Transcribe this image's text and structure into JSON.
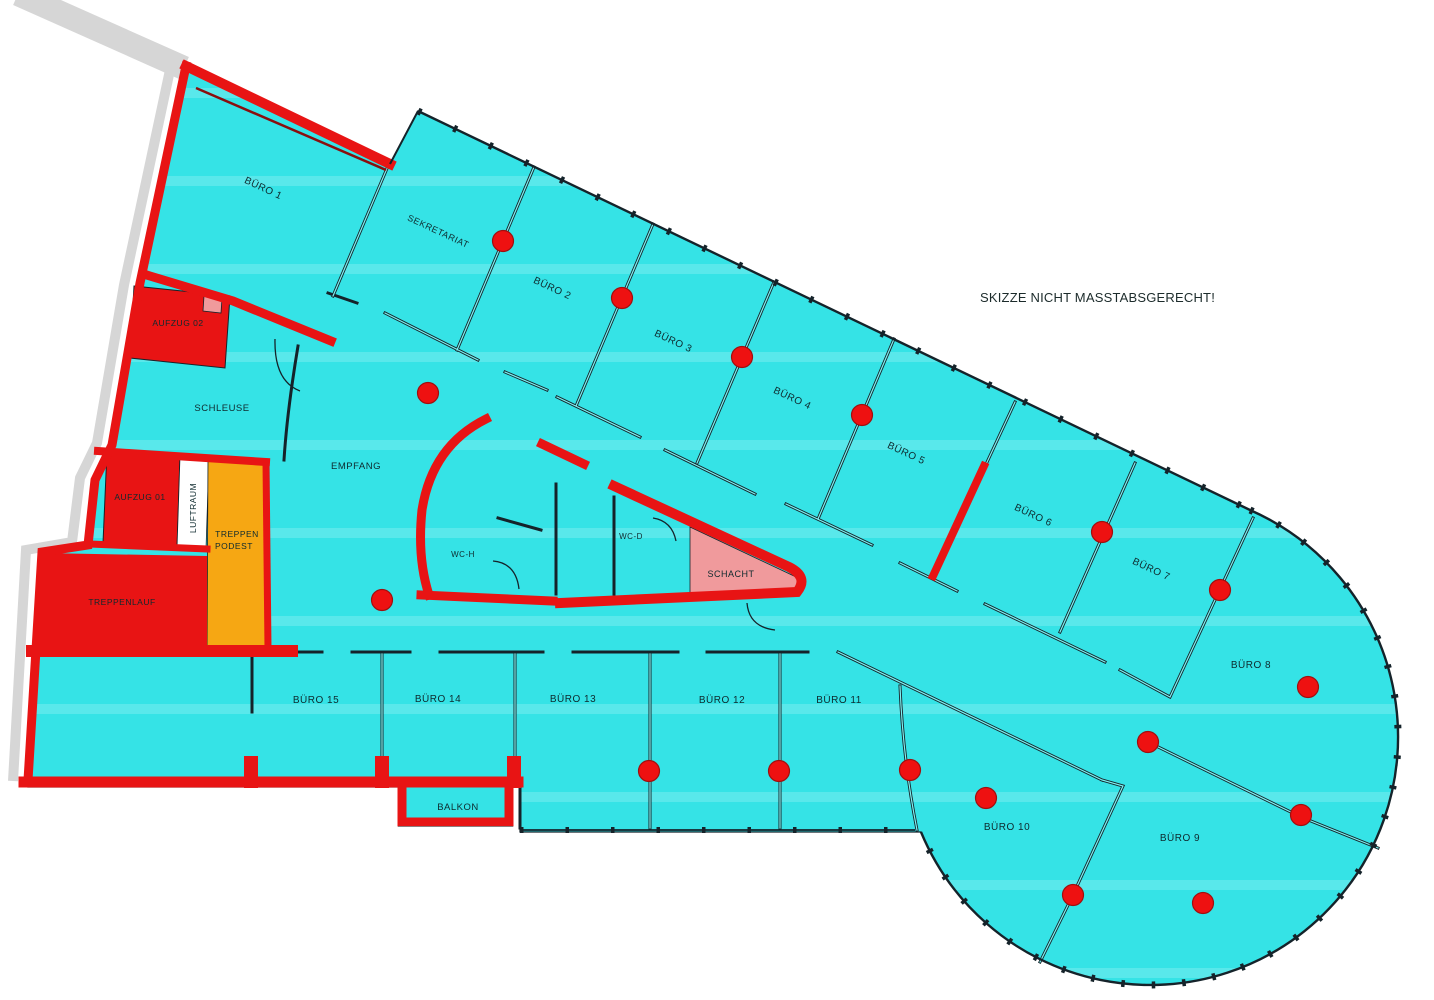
{
  "note": {
    "text": "SKIZZE NICHT  MASSTABSGERECHT!"
  },
  "colors": {
    "floor_cyan": "#35e3e6",
    "wall_red": "#e81414",
    "stair_orange": "#f6a713",
    "schacht_pink": "#f09a9c",
    "outside_grey": "#d6d6d6",
    "dot_red": "#ee1111",
    "line_black": "#15232a"
  },
  "dot_radius": 10.5,
  "rooms": [
    {
      "id": "buero-1",
      "label": "BÜRO 1",
      "x": 262,
      "y": 191,
      "rot": 25,
      "size": 10
    },
    {
      "id": "sekretariat",
      "label": "SEKRETARIAT",
      "x": 437,
      "y": 234,
      "rot": 25,
      "size": 9
    },
    {
      "id": "buero-2",
      "label": "BÜRO 2",
      "x": 551,
      "y": 291,
      "rot": 25,
      "size": 10
    },
    {
      "id": "buero-3",
      "label": "BÜRO 3",
      "x": 672,
      "y": 344,
      "rot": 25,
      "size": 10
    },
    {
      "id": "buero-4",
      "label": "BÜRO 4",
      "x": 791,
      "y": 401,
      "rot": 25,
      "size": 10
    },
    {
      "id": "buero-5",
      "label": "BÜRO 5",
      "x": 905,
      "y": 456,
      "rot": 25,
      "size": 10
    },
    {
      "id": "buero-6",
      "label": "BÜRO 6",
      "x": 1032,
      "y": 518,
      "rot": 25,
      "size": 10
    },
    {
      "id": "buero-7",
      "label": "BÜRO 7",
      "x": 1150,
      "y": 572,
      "rot": 25,
      "size": 10
    },
    {
      "id": "buero-8",
      "label": "BÜRO 8",
      "x": 1251,
      "y": 668,
      "rot": 0,
      "size": 10
    },
    {
      "id": "buero-9",
      "label": "BÜRO 9",
      "x": 1180,
      "y": 841,
      "rot": 0,
      "size": 10
    },
    {
      "id": "buero-10",
      "label": "BÜRO 10",
      "x": 1007,
      "y": 830,
      "rot": 0,
      "size": 10
    },
    {
      "id": "buero-11",
      "label": "BÜRO 11",
      "x": 839,
      "y": 703,
      "rot": 0,
      "size": 10
    },
    {
      "id": "buero-12",
      "label": "BÜRO 12",
      "x": 722,
      "y": 703,
      "rot": 0,
      "size": 10
    },
    {
      "id": "buero-13",
      "label": "BÜRO 13",
      "x": 573,
      "y": 702,
      "rot": 0,
      "size": 10
    },
    {
      "id": "buero-14",
      "label": "BÜRO 14",
      "x": 438,
      "y": 702,
      "rot": 0,
      "size": 10
    },
    {
      "id": "buero-15",
      "label": "BÜRO 15",
      "x": 316,
      "y": 703,
      "rot": 0,
      "size": 10
    },
    {
      "id": "balkon",
      "label": "BALKON",
      "x": 458,
      "y": 810,
      "rot": 0,
      "size": 9.5
    },
    {
      "id": "empfang",
      "label": "EMPFANG",
      "x": 356,
      "y": 469,
      "rot": 0,
      "size": 9.5
    },
    {
      "id": "schleuse",
      "label": "SCHLEUSE",
      "x": 222,
      "y": 411,
      "rot": 0,
      "size": 9.5
    },
    {
      "id": "aufzug-02",
      "label": "AUFZUG 02",
      "x": 178,
      "y": 326,
      "rot": 0,
      "size": 8.5
    },
    {
      "id": "aufzug-01",
      "label": "AUFZUG 01",
      "x": 140,
      "y": 500,
      "rot": 0,
      "size": 8.5
    },
    {
      "id": "luftraum",
      "label": "LUFTRAUM",
      "x": 196,
      "y": 508,
      "rot": -90,
      "size": 8.5
    },
    {
      "id": "treppen",
      "label": "TREPPEN",
      "x": 237,
      "y": 537,
      "rot": 0,
      "size": 8.5
    },
    {
      "id": "podest",
      "label": "PODEST",
      "x": 234,
      "y": 549,
      "rot": 0,
      "size": 8.5
    },
    {
      "id": "treppenlauf",
      "label": "TREPPENLAUF",
      "x": 122,
      "y": 605,
      "rot": 0,
      "size": 8.5
    },
    {
      "id": "wc-h",
      "label": "WC-H",
      "x": 463,
      "y": 557,
      "rot": 0,
      "size": 8
    },
    {
      "id": "wc-d",
      "label": "WC-D",
      "x": 631,
      "y": 539,
      "rot": 0,
      "size": 8
    },
    {
      "id": "schacht",
      "label": "SCHACHT",
      "x": 731,
      "y": 577,
      "rot": 0,
      "size": 9
    }
  ],
  "dots": [
    [
      503,
      241
    ],
    [
      622,
      298
    ],
    [
      742,
      357
    ],
    [
      862,
      415
    ],
    [
      1102,
      532
    ],
    [
      1220,
      590
    ],
    [
      1308,
      687
    ],
    [
      428,
      393
    ],
    [
      382,
      600
    ],
    [
      649,
      771
    ],
    [
      779,
      771
    ],
    [
      910,
      770
    ],
    [
      986,
      798
    ],
    [
      1148,
      742
    ],
    [
      1073,
      895
    ],
    [
      1203,
      903
    ],
    [
      1301,
      815
    ]
  ]
}
